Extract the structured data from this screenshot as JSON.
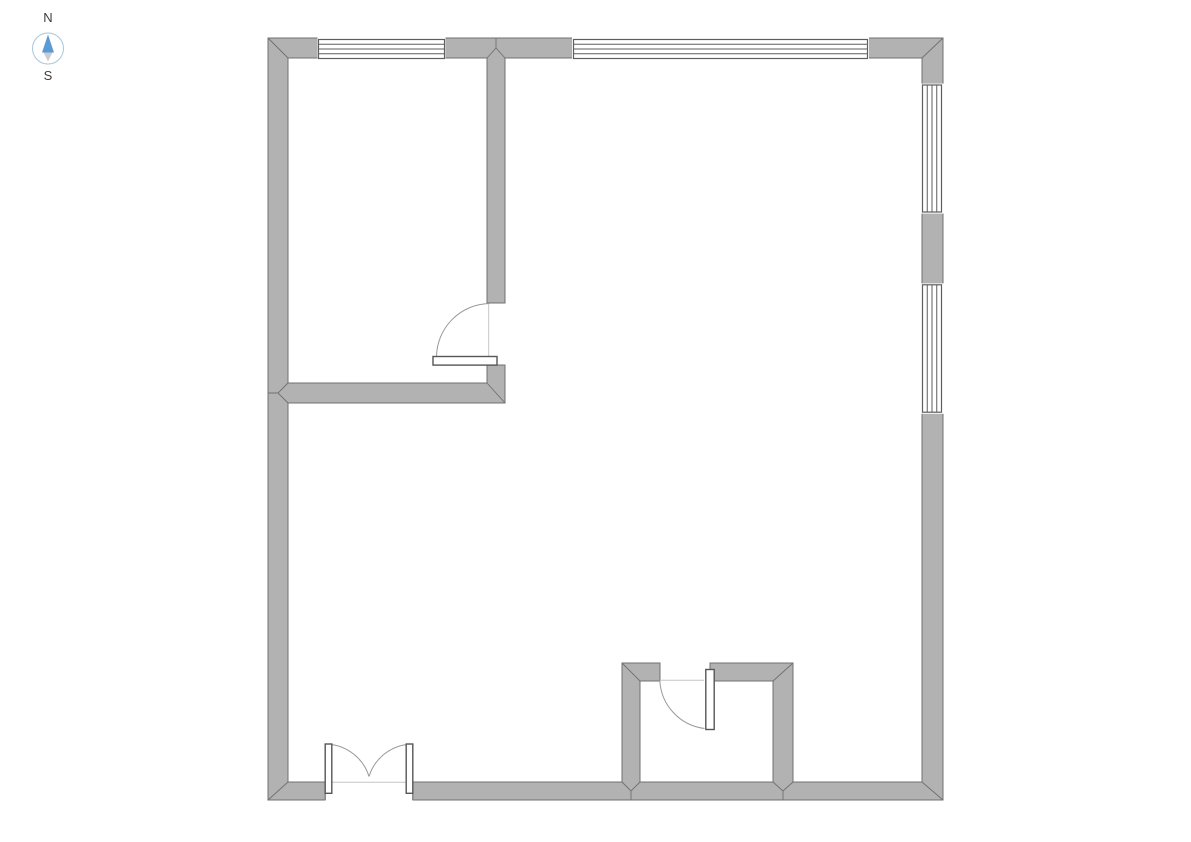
{
  "compass": {
    "north_label": "N",
    "south_label": "S",
    "ring_color": "#a5c8dc",
    "needle_north_color": "#5b9bd5",
    "needle_south_color": "#c9ccd1",
    "label_color": "#3d3d3d"
  },
  "plan": {
    "colors": {
      "background": "#ffffff",
      "wall_fill": "#b2b2b2",
      "wall_line": "#707070",
      "window_line": "#5e5e5e",
      "door_line": "#565656",
      "arc_line": "#999999",
      "faint_line": "#c6c6c6"
    },
    "wall_fills": [
      "M268 38H943V800H268Z M288 58H922V782H288Z",
      "M487 58H505V303H487Z",
      "M288 383H487V365H505V403H288Z",
      "M622 663H660V681H640V782H622Z",
      "M710 663H793V782H773V681H710Z"
    ],
    "wall_outlines": [
      "M268 38H943V800H268Z",
      "M288 58H487M505 58H922M922 58V782M288 58V383M288 403V782M288 782H622M640 782H773M793 782H922",
      "M487 58V303H505V58",
      "M288 383H487V365H505V403H288",
      "M622 782V663H660V681H640V782",
      "M773 782V681H710V663H793V782"
    ],
    "miter_joints": [
      "M268 38L288 58",
      "M943 38L922 58",
      "M268 800L288 782",
      "M943 800L922 782",
      "M487 58L496 48L505 58M496 48V38",
      "M288 383L278 393L288 403M278 393H268",
      "M487 383L505 403",
      "M622 663L640 681",
      "M793 663L773 681",
      "M622 782L631 791L640 782M631 791V800",
      "M773 782L783 791L793 782M783 791V800"
    ],
    "windows": [
      {
        "id": "window-top-left",
        "erase": [
          317.5,
          36.8,
          128,
          23.8
        ],
        "frame": [
          318.5,
          39.5,
          126,
          19
        ],
        "glazing": "M318.5 44.25H444.5M318.5 49H444.5M318.5 53.75H444.5"
      },
      {
        "id": "window-top-right",
        "erase": [
          572,
          36.8,
          297,
          23.8
        ],
        "frame": [
          573.5,
          39.5,
          294,
          19
        ],
        "glazing": "M573.5 44.25H867.5M573.5 49H867.5M573.5 53.75H867.5"
      },
      {
        "id": "window-right-upper",
        "erase": [
          920.6,
          83.6,
          23.6,
          130
        ],
        "frame": [
          922.5,
          85,
          19,
          127
        ],
        "glazing": "M927.25 85V212M932 85V212M936.75 85V212"
      },
      {
        "id": "window-right-lower",
        "erase": [
          920.6,
          283.4,
          23.6,
          130.4
        ],
        "frame": [
          922.5,
          284.8,
          19,
          127.4
        ],
        "glazing": "M927.25 284.8V412.2M932 284.8V412.2M936.75 284.8V412.2"
      }
    ],
    "opening_erases": [
      [
        324.8,
        780.8,
        88.4,
        20.6
      ]
    ],
    "opening_caps": "M325.2 781.6V800.4M412.8 781.6V800.4",
    "opening_faint_lines": "M326 782.3H412M660 680.3H704M488.7 304V356",
    "doors": [
      {
        "id": "interior-door",
        "leaf": [
          433,
          356.5,
          64,
          8.6
        ],
        "swing": "M436.5 356.5A54 54 0 0 1 489.5 303.5"
      },
      {
        "id": "small-room-door",
        "leaf": [
          705.8,
          669.5,
          8.4,
          60
        ],
        "swing": "M704.5 728.5A51 51 0 0 1 659.8 680.5"
      },
      {
        "id": "double-door-left",
        "leaf": [
          325.2,
          744,
          6.6,
          49.3
        ],
        "swing": "M328.6 744.2A46 46 0 0 1 369 776.5"
      },
      {
        "id": "double-door-right",
        "leaf": [
          406.2,
          744,
          6.6,
          49.3
        ],
        "swing": "M409.4 744.2A46 46 0 0 0 369 776.5"
      }
    ]
  }
}
